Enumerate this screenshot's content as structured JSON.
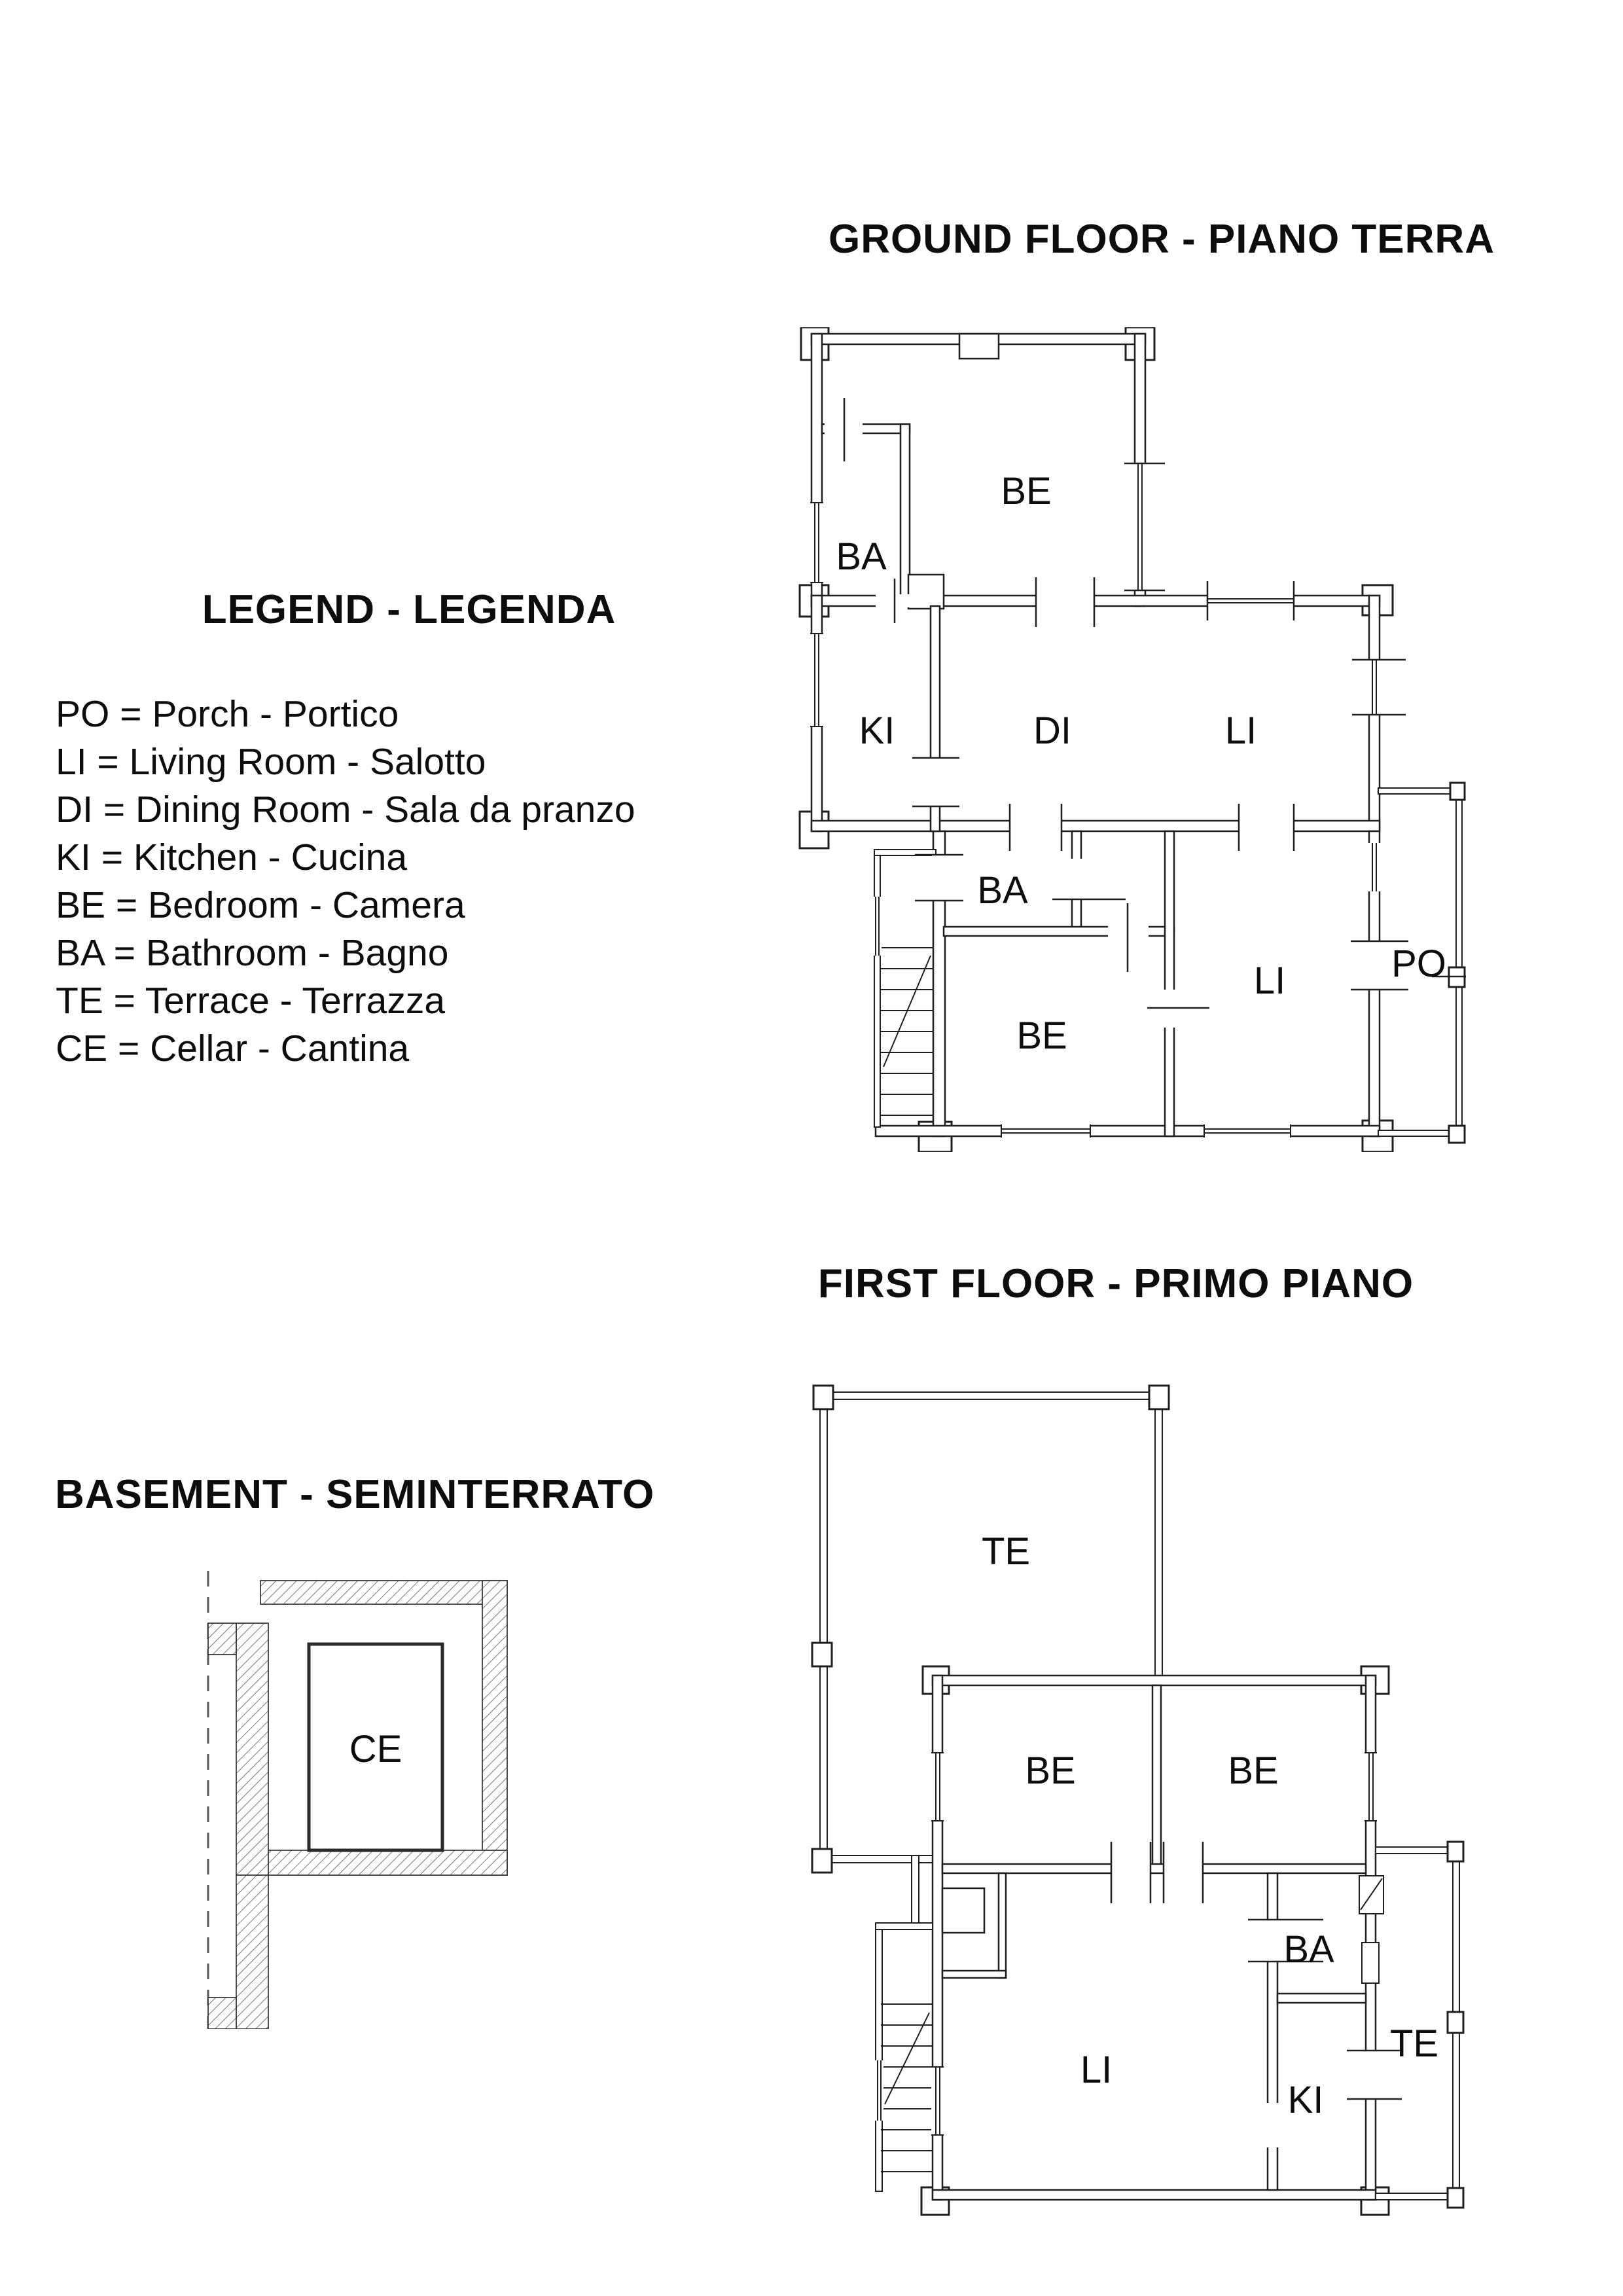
{
  "colors": {
    "line": "#1f1f1f",
    "background": "#ffffff"
  },
  "legend": {
    "title": "LEGEND - LEGENDA",
    "items": [
      "PO = Porch - Portico",
      "LI = Living Room - Salotto",
      "DI = Dining Room - Sala da pranzo",
      "KI = Kitchen - Cucina",
      "BE = Bedroom - Camera",
      "BA = Bathroom - Bagno",
      "TE = Terrace - Terrazza",
      "CE = Cellar - Cantina"
    ]
  },
  "ground_floor": {
    "title": "GROUND FLOOR - PIANO TERRA",
    "rooms": {
      "bedroom_top": "BE",
      "bathroom_top": "BA",
      "kitchen": "KI",
      "dining": "DI",
      "living_mid": "LI",
      "bathroom_small": "BA",
      "bedroom_bottom": "BE",
      "living_bottom": "LI",
      "porch": "PO"
    }
  },
  "first_floor": {
    "title": "FIRST FLOOR - PRIMO PIANO",
    "rooms": {
      "terrace_large": "TE",
      "bedroom_left": "BE",
      "bedroom_right": "BE",
      "bathroom": "BA",
      "living": "LI",
      "kitchen": "KI",
      "terrace_right": "TE"
    }
  },
  "basement": {
    "title": "BASEMENT - SEMINTERRATO",
    "rooms": {
      "cellar": "CE"
    }
  }
}
